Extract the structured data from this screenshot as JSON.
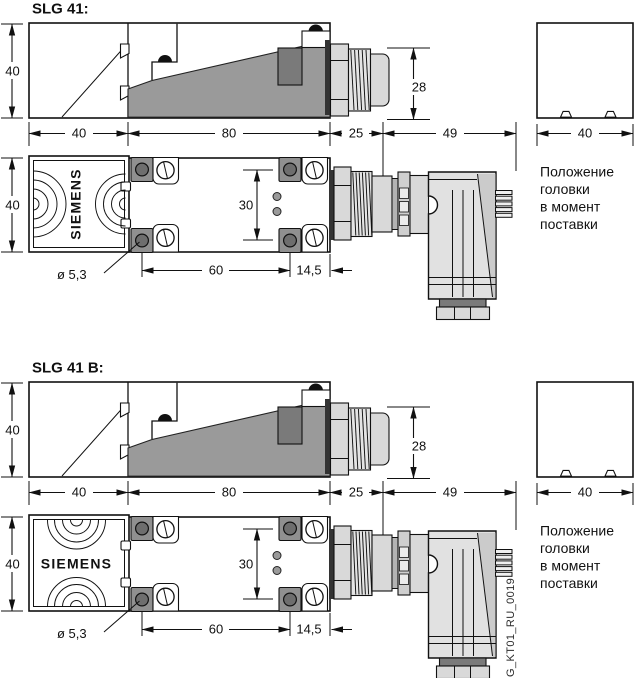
{
  "drawing": {
    "doc_code": "G_KT01_RU_0019",
    "brand_label": "SIEMENS",
    "head_position_note": [
      "Положение",
      "головки",
      "в момент",
      "поставки"
    ],
    "colors": {
      "line": "#111111",
      "wedge_gray": "#9a9a9a",
      "terminal_gray": "#7a7a7a",
      "metal_gray": "#d9d9d9",
      "plug_gray": "#e1e1e1"
    },
    "sections": [
      {
        "title": "SLG 41:",
        "dims": {
          "body_height": "40",
          "head_length": "40",
          "body_length": "80",
          "gland_length": "25",
          "plug_length": "49",
          "gland_height": "28",
          "body_width": "40",
          "led_spacing": "30",
          "hole_spacing": "60",
          "hole_edge_offset": "14,5",
          "hole_diameter": "ø 5,3",
          "head_box_width": "40"
        }
      },
      {
        "title": "SLG 41 B:",
        "dims": {
          "body_height": "40",
          "head_length": "40",
          "body_length": "80",
          "gland_length": "25",
          "plug_length": "49",
          "gland_height": "28",
          "body_width": "40",
          "led_spacing": "30",
          "hole_spacing": "60",
          "hole_edge_offset": "14,5",
          "hole_diameter": "ø 5,3",
          "head_box_width": "40"
        }
      }
    ]
  }
}
